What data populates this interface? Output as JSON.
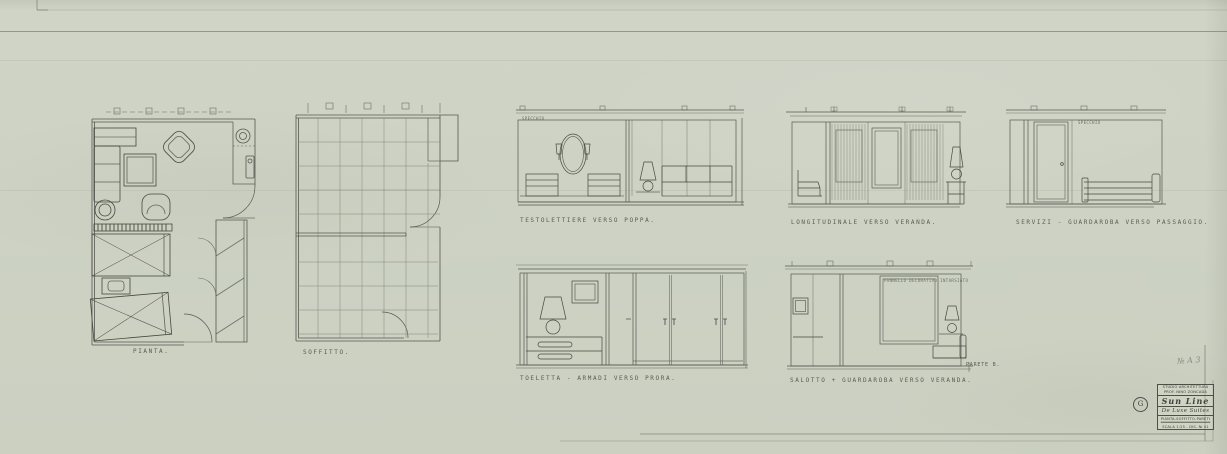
{
  "sheet": {
    "paper_color": "#cdd2c4",
    "line_color": "#565850",
    "pencil_note": "№ A 3"
  },
  "labels": {
    "plan": "PIANTA.",
    "ceiling": "SOFFITTO.",
    "elev_beds": "TESTOLETTIERE  VERSO  POPPA.",
    "elev_windows": "LONGITUDINALE  VERSO  VERANDA.",
    "elev_corridor": "SERVIZI - GUARDAROBA  VERSO  PASSAGGIO.",
    "elev_toeletta": "TOELETTA - ARMADI  VERSO  PRORA.",
    "elev_salotto": "SALOTTO + GUARDAROBA  VERSO  VERANDA.",
    "parete_note": "PARETE B.",
    "specchio_note": "SPECCHIO",
    "panel_note": "PANNELLO  DECORATIVO  INTARSIATO"
  },
  "title_block": {
    "studio_line1": "STUDIO ARCHITETTURA",
    "studio_line2": "PROF. NINO ZONCADA",
    "project": "Sun Line",
    "subject": "De Luxe Suites",
    "content_line": "PIANTA-SOFFITTO-PARETI",
    "scale_line": "SCALA 1:25 - DIS. № 41",
    "revision_mark": "G"
  }
}
